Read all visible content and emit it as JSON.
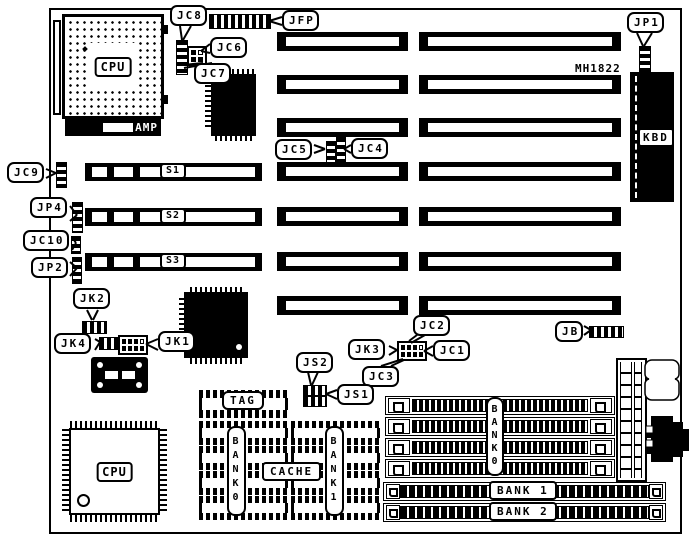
{
  "diagram": {
    "model": "MH1822",
    "colors": {
      "ink": "#000000",
      "paper": "#ffffff"
    }
  },
  "chips": {
    "cpu_socket": "CPU",
    "amp": "AMP",
    "cpu_qfp": "CPU",
    "kbd": "KBD",
    "tag": "TAG",
    "cache": "CACHE"
  },
  "slots": {
    "s1": "S1",
    "s2": "S2",
    "s3": "S3"
  },
  "memory": {
    "simm_bank0": "BANK0",
    "bank1": "BANK 1",
    "bank2": "BANK 2",
    "cache_bank0": "BANK0",
    "cache_bank1": "BANK1"
  },
  "connectors": {
    "jfp": "JFP",
    "jb": "JB",
    "jp1": "JP1",
    "jp2": "JP2",
    "jp4": "JP4",
    "jc1": "JC1",
    "jc2": "JC2",
    "jc3": "JC3",
    "jc4": "JC4",
    "jc5": "JC5",
    "jc6": "JC6",
    "jc7": "JC7",
    "jc8": "JC8",
    "jc9": "JC9",
    "jc10": "JC10",
    "jk1": "JK1",
    "jk2": "JK2",
    "jk3": "JK3",
    "jk4": "JK4",
    "js1": "JS1",
    "js2": "JS2"
  }
}
